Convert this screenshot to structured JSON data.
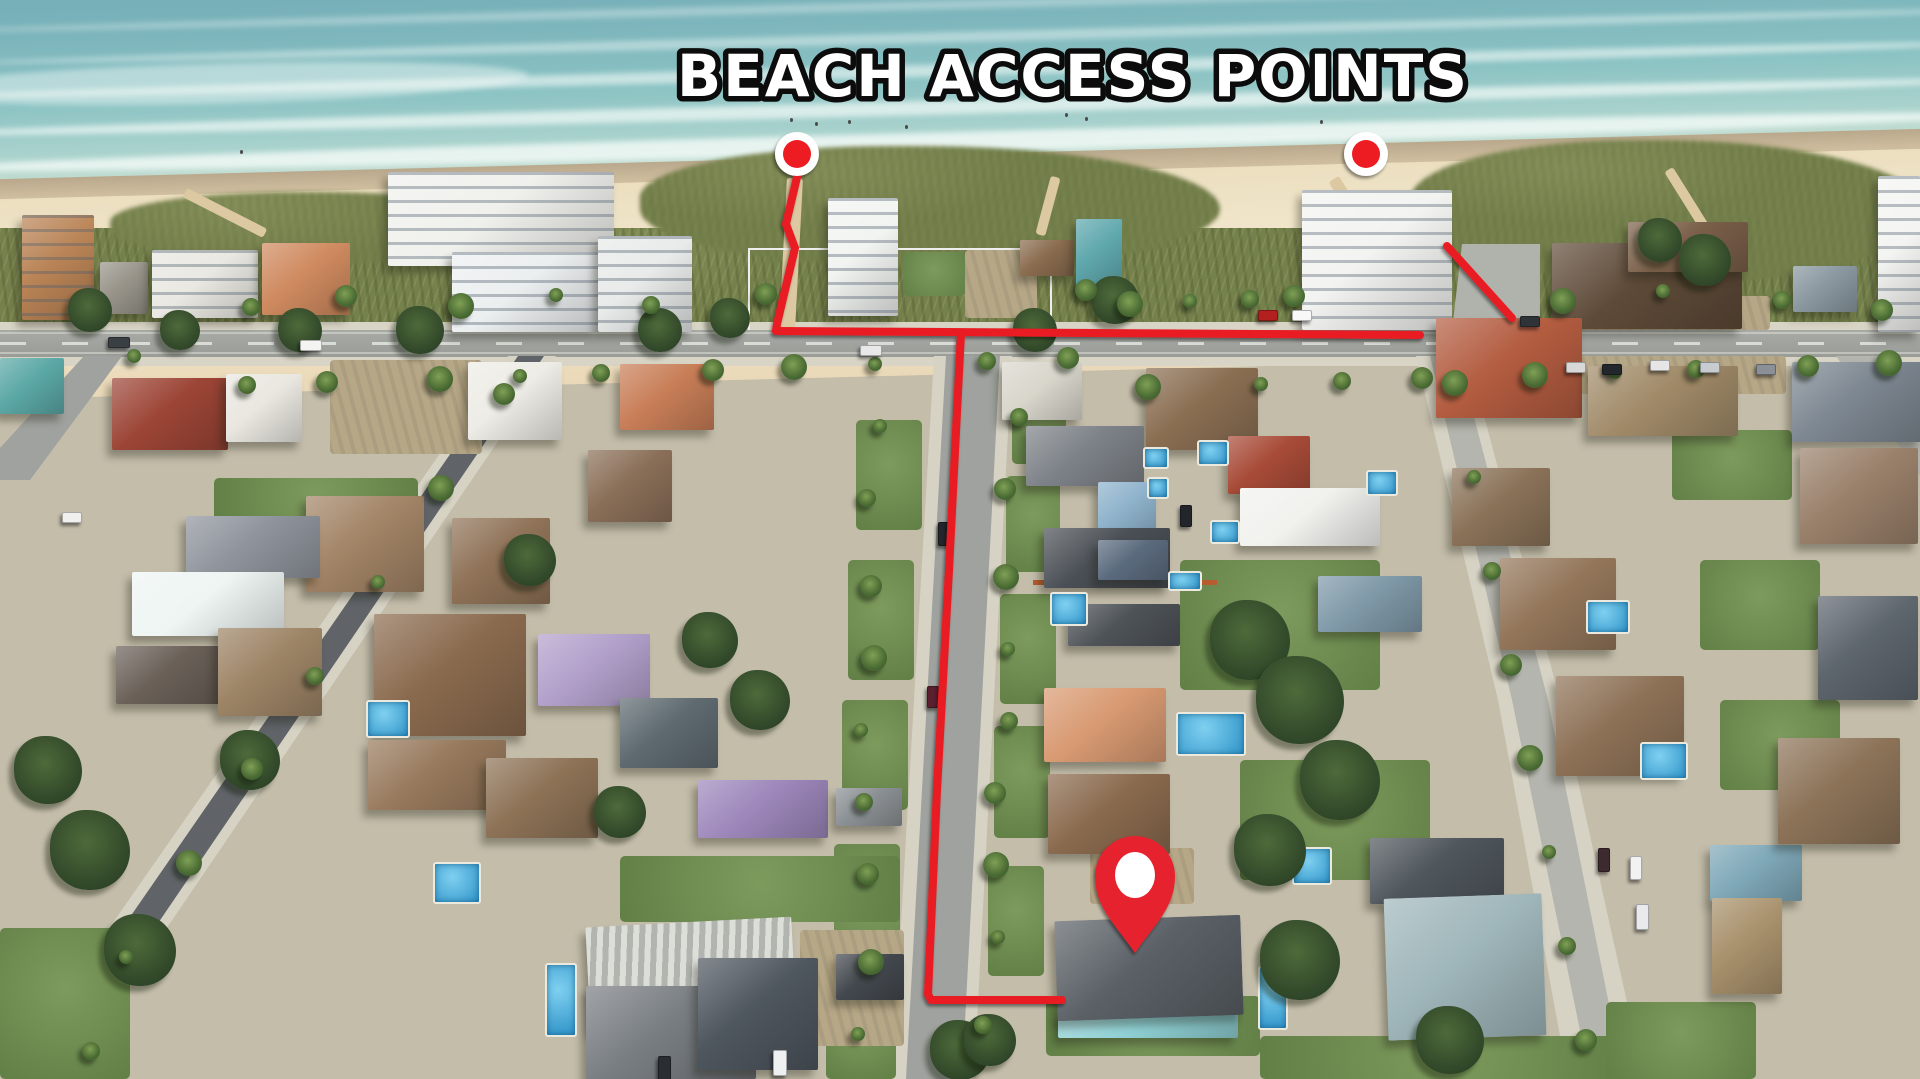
{
  "image_type": "annotated aerial drone photo of beachfront neighborhood",
  "title": {
    "text": "BEACH ACCESS POINTS",
    "fill": "#ffffff",
    "outline": "#0c0c0c"
  },
  "annotations": {
    "route_color": "#e81b22",
    "marker_fill": "#ec1c20",
    "marker_ring": "#ffffff",
    "pin_color": "#e6242d",
    "pin_inner": "#ffffff",
    "markers": [
      {
        "name": "beach-access-marker-left",
        "cx": 797,
        "cy": 154,
        "outer_r": 22,
        "inner_r": 14
      },
      {
        "name": "beach-access-marker-right",
        "cx": 1366,
        "cy": 154,
        "outer_r": 22,
        "inner_r": 14
      }
    ],
    "routes": [
      {
        "name": "left-access-path",
        "points": [
          [
            797,
            177
          ],
          [
            786,
            224
          ],
          [
            795,
            248
          ],
          [
            777,
            324
          ],
          [
            776,
            331
          ]
        ]
      },
      {
        "name": "boulevard-route",
        "points": [
          [
            776,
            331
          ],
          [
            1420,
            335
          ]
        ]
      },
      {
        "name": "street-route-to-home",
        "points": [
          [
            961,
            333
          ],
          [
            949,
            570
          ],
          [
            937,
            790
          ],
          [
            928,
            994
          ],
          [
            931,
            1000
          ],
          [
            1062,
            1000
          ]
        ]
      },
      {
        "name": "right-access-path",
        "points": [
          [
            1447,
            246
          ],
          [
            1512,
            318
          ]
        ]
      }
    ],
    "home_pin": {
      "cx": 1135,
      "tip_y": 953,
      "head_cy": 876,
      "head_r": 40,
      "inner_rx": 20,
      "inner_ry": 23
    }
  },
  "scene_palette": {
    "ocean": "#79b2ba",
    "surf_foam": "#f4fbf8",
    "sand": "#ecdfc0",
    "dune_grass": "#75814b",
    "asphalt": "#a8aaa6",
    "dark_asphalt": "#606468",
    "concrete": "#d8d4c6",
    "lawn": "#6f8f50",
    "pool_water": "#3fa3d8"
  }
}
